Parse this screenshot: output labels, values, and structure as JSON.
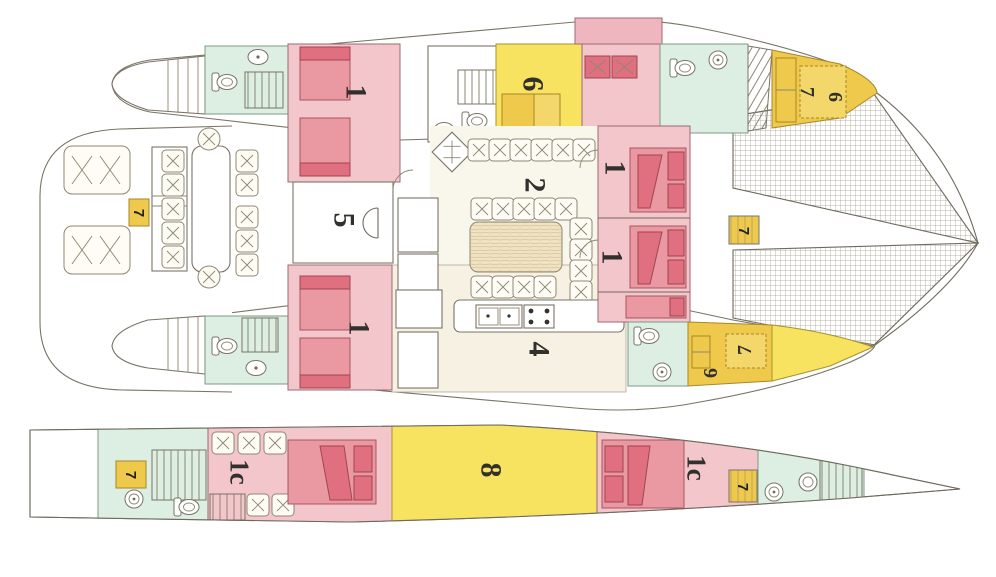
{
  "colors": {
    "cabin_pink": "#f3c6cb",
    "bed_pink": "#ea98a2",
    "bed_dark_pink": "#e0707f",
    "room_yellow": "#f8e361",
    "bunk_gold": "#efc94c",
    "bath_mint": "#dcefe2",
    "floor_ivory": "#f9f6ec",
    "outline": "#6f6a5e"
  },
  "main_deck": {
    "labels": {
      "c1_top_left": "1",
      "c1_bottom_left": "1",
      "c1_mid_top": "1",
      "c1_mid_bottom": "1",
      "salon": "2",
      "galley": "4",
      "nav_room": "5",
      "cabin6": "6",
      "bow_port_7": "7",
      "bow_port_6": "6",
      "bow_stbd_7": "7",
      "bow_stbd_6": "6",
      "steps_mid": "7",
      "steps_aft": "7"
    }
  },
  "lower_deck": {
    "labels": {
      "cabin_1c_left": "1c",
      "engine_room": "8",
      "cabin_1c_right": "1c",
      "steps_left": "7",
      "steps_right": "7"
    }
  }
}
